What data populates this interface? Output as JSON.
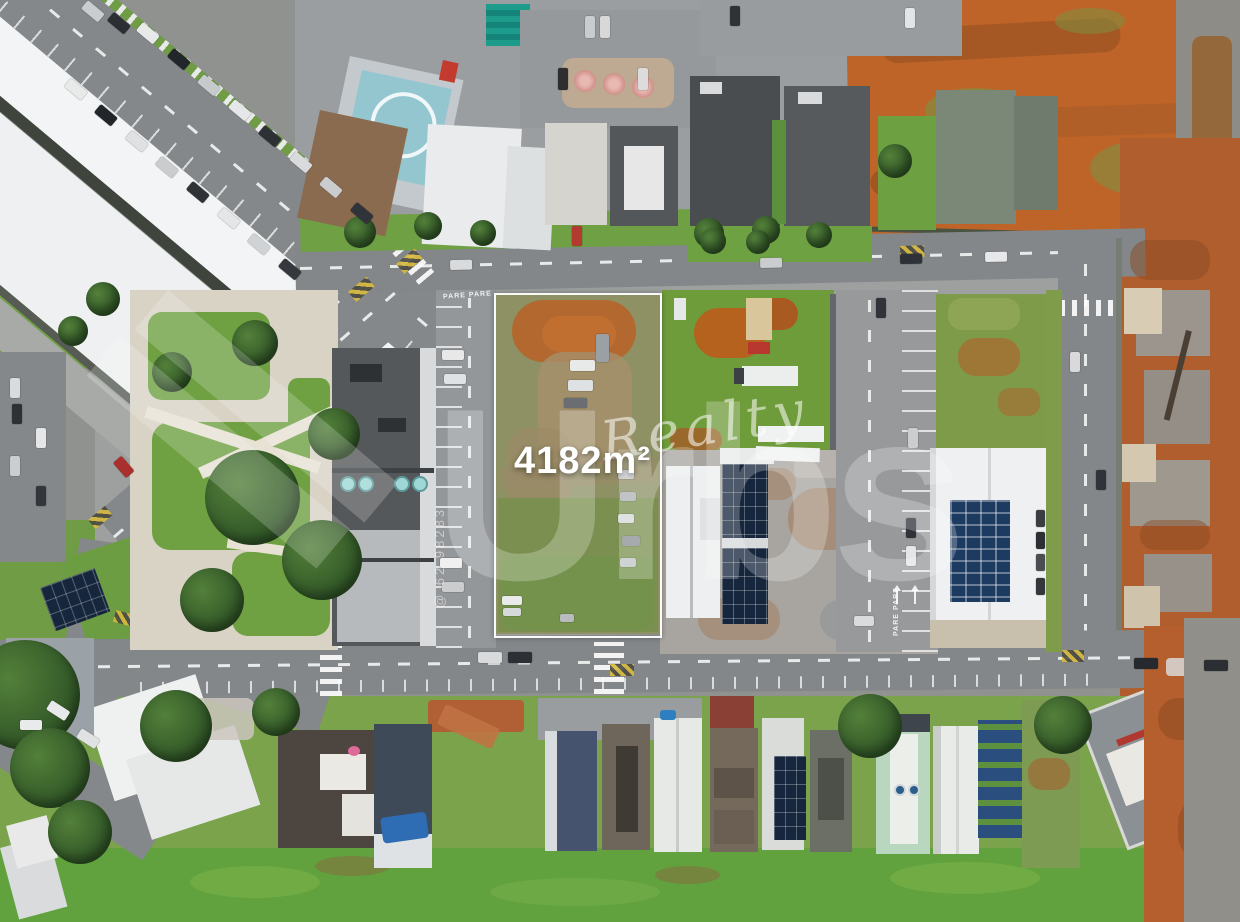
{
  "scene": {
    "description": "Aerial drone photo of an urban block with a vacant corner lot outlined in white for sale",
    "setting": "city block with warehouses, towers, townhouses, construction site and red-earth fields"
  },
  "listing": {
    "area_label": "4182m²"
  },
  "watermark": {
    "brand": "Urbs",
    "suffix": "Realty",
    "contact": "@ 62 98283"
  },
  "road_markings": {
    "stop": "PARE"
  },
  "colors": {
    "plot_outline": "#ffffff",
    "grass": "#6fa044",
    "bare_earth": "#bf6429",
    "asphalt": "#83878a",
    "solar_panel": "#1d3a60",
    "warehouse_roof": "#f3f4f5"
  }
}
